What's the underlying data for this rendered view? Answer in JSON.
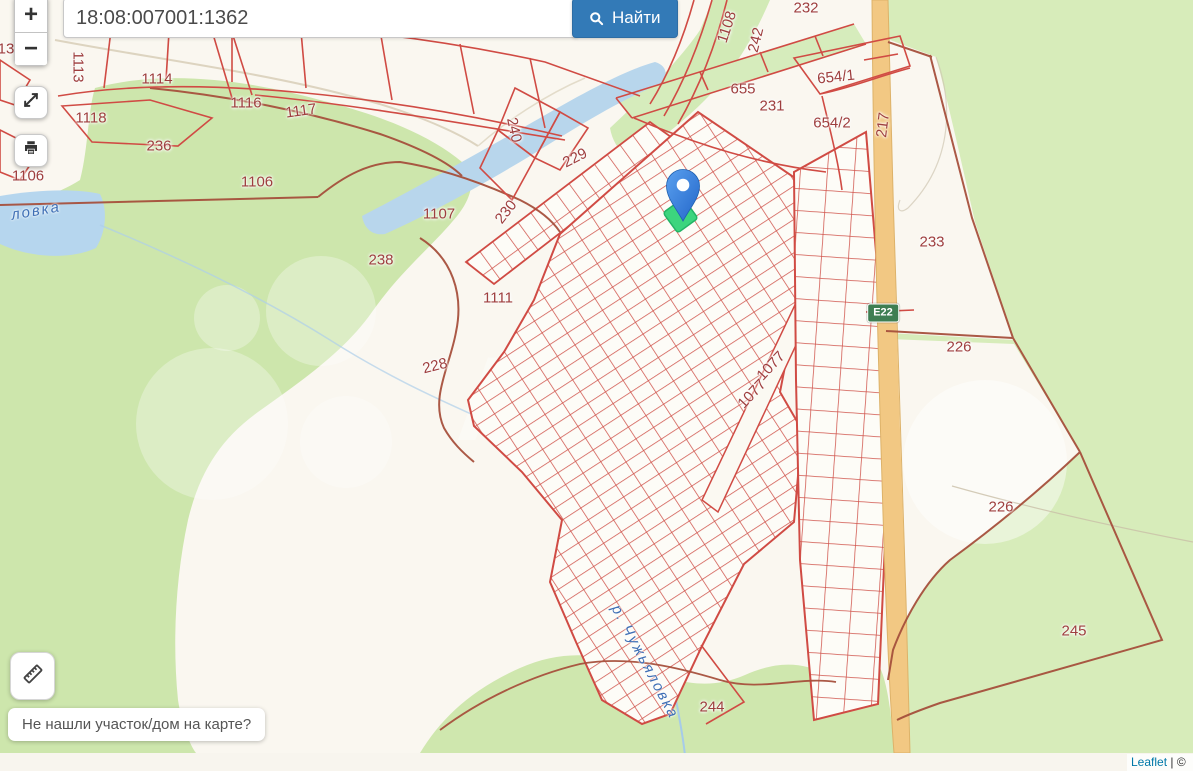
{
  "search": {
    "value": "18:08:007001:1362",
    "find_label": "Найти"
  },
  "controls": {
    "zoom_in": "+",
    "zoom_out": "−"
  },
  "icons": {
    "search": "magnifier",
    "fullscreen": "expand-arrows",
    "print": "printer",
    "measure": "ruler"
  },
  "help": {
    "text": "Не нашли участок/дом на карте?"
  },
  "attribution": {
    "leaflet": "Leaflet",
    "separator": "| ©"
  },
  "road_badge": {
    "label": "E22"
  },
  "colors": {
    "find_button": "#337ab7",
    "parcel_line": "#d04b44",
    "quarter_boundary": "#a6503c",
    "marker_blue": "#3b82e0",
    "selected_parcel_green": "#3cd57e",
    "road_badge_green": "#3e7e52",
    "forest_green": "#cde6ac",
    "water_blue": "#b6d6ee",
    "road_orange": "#f2c883"
  },
  "map": {
    "labels": [
      {
        "t": "13",
        "x": 6,
        "y": 49,
        "r": 0
      },
      {
        "t": "1113",
        "x": 78,
        "y": 67,
        "r": 90
      },
      {
        "t": "1114",
        "x": 157,
        "y": 79,
        "r": 0
      },
      {
        "t": "1116",
        "x": 246,
        "y": 103,
        "r": 0
      },
      {
        "t": "1117",
        "x": 301,
        "y": 111,
        "r": -8
      },
      {
        "t": "1118",
        "x": 91,
        "y": 118,
        "r": 0
      },
      {
        "t": "236",
        "x": 159,
        "y": 146,
        "r": 0
      },
      {
        "t": "1106",
        "x": 28,
        "y": 176,
        "r": 0
      },
      {
        "t": "1106",
        "x": 257,
        "y": 182,
        "r": 0
      },
      {
        "t": "1107",
        "x": 439,
        "y": 214,
        "r": 0
      },
      {
        "t": "238",
        "x": 381,
        "y": 260,
        "r": 0
      },
      {
        "t": "1111",
        "x": 498,
        "y": 298,
        "r": 0
      },
      {
        "t": "228",
        "x": 435,
        "y": 366,
        "r": -14
      },
      {
        "t": "240",
        "x": 514,
        "y": 130,
        "r": 78
      },
      {
        "t": "229",
        "x": 575,
        "y": 158,
        "r": -27
      },
      {
        "t": "230",
        "x": 506,
        "y": 212,
        "r": -52
      },
      {
        "t": "655",
        "x": 743,
        "y": 89,
        "r": 0
      },
      {
        "t": "231",
        "x": 772,
        "y": 106,
        "r": 0
      },
      {
        "t": "654/1",
        "x": 836,
        "y": 77,
        "r": -6
      },
      {
        "t": "654/2",
        "x": 832,
        "y": 123,
        "r": 0
      },
      {
        "t": "232",
        "x": 806,
        "y": 8,
        "r": 0
      },
      {
        "t": "1108",
        "x": 727,
        "y": 27,
        "r": -72
      },
      {
        "t": "242",
        "x": 756,
        "y": 40,
        "r": -76
      },
      {
        "t": "217",
        "x": 883,
        "y": 125,
        "r": -83
      },
      {
        "t": "233",
        "x": 932,
        "y": 242,
        "r": 0
      },
      {
        "t": "226",
        "x": 959,
        "y": 347,
        "r": 0
      },
      {
        "t": "226",
        "x": 1001,
        "y": 507,
        "r": 0
      },
      {
        "t": "245",
        "x": 1074,
        "y": 631,
        "r": 0
      },
      {
        "t": "1077",
        "x": 771,
        "y": 366,
        "r": -47
      },
      {
        "t": "1077",
        "x": 752,
        "y": 394,
        "r": -47
      },
      {
        "t": "244",
        "x": 712,
        "y": 707,
        "r": 0
      }
    ],
    "river_labels": [
      {
        "t": "р. Чужьяловка",
        "x": 645,
        "y": 662,
        "r": 62
      },
      {
        "t": "ловка",
        "x": 36,
        "y": 211,
        "r": -10
      }
    ]
  }
}
